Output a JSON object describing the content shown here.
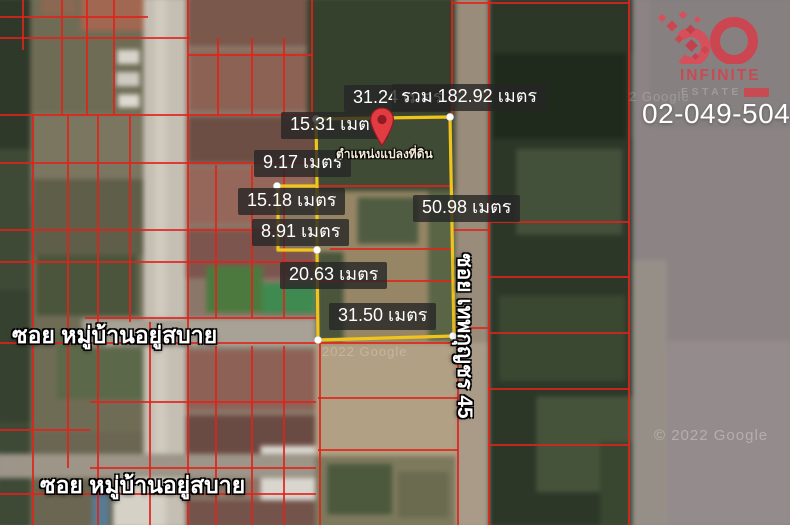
{
  "branding": {
    "logo_text": "INFINITE",
    "logo_subtext": "ESTATE",
    "phone": "02-049-5049"
  },
  "overlay": {
    "pin_label": "ตำแหน่งแปลงที่ดิน",
    "measurements": [
      {
        "label": "31.24 เมตร"
      },
      {
        "label": "รวม 182.92 เมตร"
      },
      {
        "label": "15.31 เมตร"
      },
      {
        "label": "9.17 เมตร"
      },
      {
        "label": "15.18 เมตร"
      },
      {
        "label": "8.91 เมตร"
      },
      {
        "label": "20.63 เมตร"
      },
      {
        "label": "31.50 เมตร"
      },
      {
        "label": "50.98 เมตร"
      }
    ],
    "roads": {
      "soi_top": "ซอย หมู่บ้านอยู่สบาย",
      "soi_bottom": "ซอย หมู่บ้านอยู่สบาย",
      "soi_vertical": "ซอย เทพกุญชร 45"
    },
    "watermarks": [
      {
        "text": "2022 Google"
      },
      {
        "text": "2 Google"
      },
      {
        "text": "© 2022 Google"
      }
    ],
    "colors": {
      "parcel_line": "#e2231a",
      "plot_outline": "#f0c41b",
      "pin": "#e23b41"
    }
  }
}
